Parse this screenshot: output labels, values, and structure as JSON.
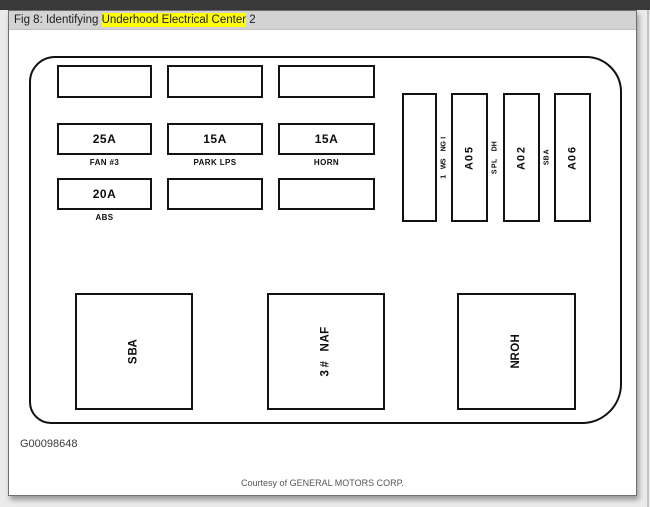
{
  "header": {
    "title_prefix": "Fig 8: Identifying ",
    "title_highlight": "Underhood Electrical Center",
    "title_suffix": " 2",
    "highlight_color": "#ffff00"
  },
  "diagram": {
    "top_row_boxes": [
      "",
      "",
      ""
    ],
    "fuse_rows": [
      {
        "fuses": [
          {
            "amp": "25A",
            "label": "FAN #3"
          },
          {
            "amp": "15A",
            "label": "PARK LPS"
          },
          {
            "amp": "15A",
            "label": "HORN"
          }
        ]
      },
      {
        "fuses": [
          {
            "amp": "20A",
            "label": "ABS"
          },
          {
            "amp": "",
            "label": ""
          },
          {
            "amp": "",
            "label": ""
          }
        ]
      }
    ],
    "vertical_fuses": [
      {
        "amp": "",
        "side_label": "IGN SW 1"
      },
      {
        "amp": "50A",
        "side_label": "HD LPS"
      },
      {
        "amp": "20A",
        "side_label": "ABS"
      },
      {
        "amp": "60A",
        "side_label": ""
      }
    ],
    "relays": [
      "ABS",
      "FAN #3",
      "HORN"
    ],
    "figure_id": "G00098648",
    "courtesy": "Courtesy of GENERAL MOTORS CORP."
  }
}
